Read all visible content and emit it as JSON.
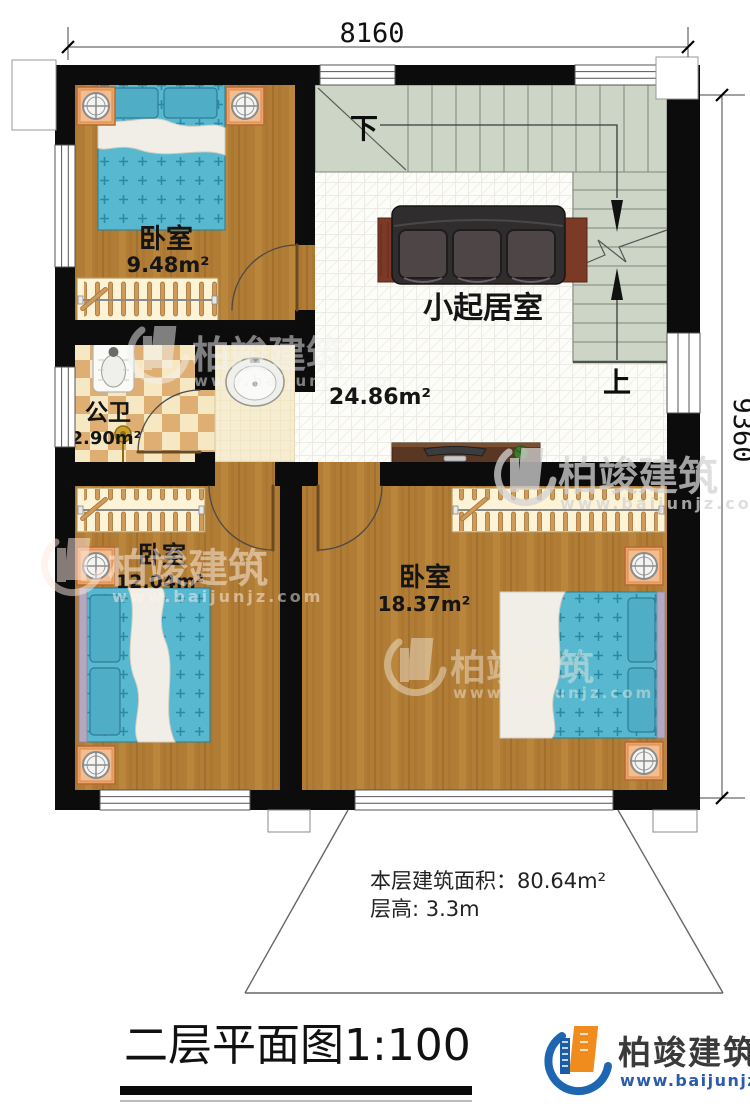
{
  "plan": {
    "dim_top": "8160",
    "dim_right": "9360",
    "rooms": {
      "bedroom1": {
        "label": "卧室",
        "area": "9.48m²"
      },
      "bathroom": {
        "label": "公卫",
        "area": "2.90m²"
      },
      "living": {
        "label": "小起居室",
        "area": "24.86m²"
      },
      "bedroom2": {
        "label": "卧室",
        "area": "12.04m²"
      },
      "bedroom3": {
        "label": "卧室",
        "area": "18.37m²"
      }
    },
    "stairs": {
      "down": "下",
      "up": "上"
    },
    "notes": {
      "line1": "本层建筑面积：80.64m²",
      "line2": "层高: 3.3m"
    }
  },
  "footer": {
    "title": "二层平面图1:100"
  },
  "brand": {
    "name": "柏竣建筑",
    "url": "www.baijunjz.com"
  },
  "watermark": {
    "name": "柏竣建筑",
    "url": "www.baijunjz.com"
  },
  "colors": {
    "wall": "#0c0c0c",
    "wood": "#b17c35",
    "tile": "#fcfcf9",
    "stair": "#cdd5c6",
    "bed": "#57b8d0",
    "checker_light": "#f6e8c3",
    "checker_dark": "#deae72",
    "brand_blue": "#1f66b0",
    "brand_orange": "#f08c1e",
    "url_blue": "#2a5caa"
  }
}
